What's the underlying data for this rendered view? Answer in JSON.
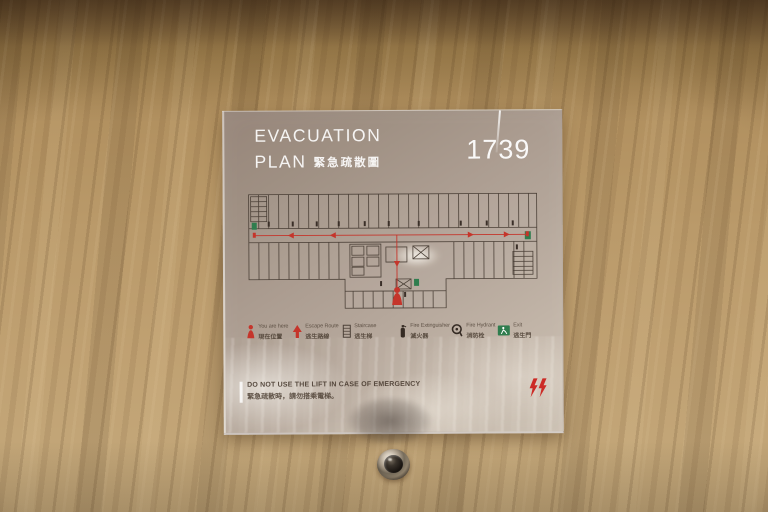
{
  "sign": {
    "title_line1": "EVACUATION",
    "title_line2_en": "PLAN",
    "title_line2_zh": "緊急疏散圖",
    "room_number": "1739",
    "legend": [
      {
        "icon": "you-are-here-icon",
        "en": "You are here",
        "zh": "現在位置"
      },
      {
        "icon": "escape-route-icon",
        "en": "Escape Route",
        "zh": "逃生路線"
      },
      {
        "icon": "staircase-icon",
        "en": "Staircase",
        "zh": "逃生梯"
      },
      {
        "icon": "fire-extinguisher-icon",
        "en": "Fire Extinguisher",
        "zh": "滅火器"
      },
      {
        "icon": "fire-hydrant-icon",
        "en": "Fire Hydrant",
        "zh": "消防栓"
      },
      {
        "icon": "exit-icon",
        "en": "Exit",
        "zh": "逃生門"
      }
    ],
    "warning": {
      "en": "DO NOT USE THE LIFT IN CASE OF EMERGENCY",
      "zh": "緊急疏散時，請勿搭乘電梯。"
    },
    "brand_logo": "w-hotels-logo"
  },
  "colors": {
    "wall_wood": "#b1905f",
    "sign_panel": "#b0a096",
    "route_red": "#c5352b",
    "exit_green": "#2f7d4e",
    "plan_line": "#4c4138",
    "title_white": "#f5f1ea",
    "label_dark": "#4f4236"
  },
  "scene": {
    "objects": [
      "wooden-door",
      "evacuation-sign",
      "door-peephole"
    ]
  }
}
